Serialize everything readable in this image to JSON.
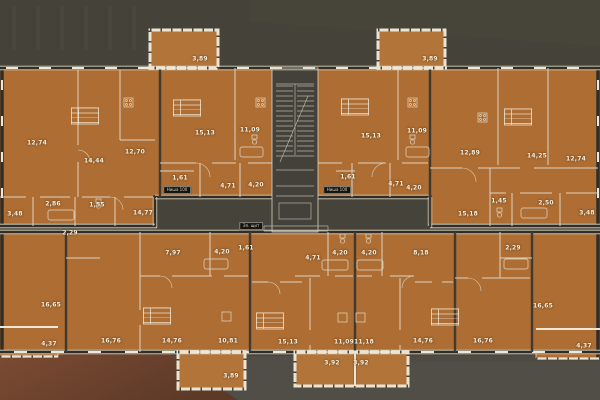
{
  "meta": {
    "title": "Типовой этаж — план квартир",
    "units": "m2"
  },
  "colors": {
    "background_top": "#46433a",
    "background_bottom": "#514e47",
    "plan_fill": "#ad6d33",
    "wall_light": "#ddd4c0",
    "window_light": "#efe8d8",
    "wall_dark": "#312e28",
    "rust_overlay": "#7c4b33",
    "label_text": "#f7eedd"
  },
  "rooms": [
    {
      "label": "12,74",
      "x": 37,
      "y": 143
    },
    {
      "label": "14,44",
      "x": 94,
      "y": 161
    },
    {
      "label": "12,70",
      "x": 135,
      "y": 152
    },
    {
      "label": "3,48",
      "x": 15,
      "y": 214
    },
    {
      "label": "2,86",
      "x": 53,
      "y": 204
    },
    {
      "label": "1,55",
      "x": 97,
      "y": 205
    },
    {
      "label": "14,77",
      "x": 143,
      "y": 213
    },
    {
      "label": "3,89",
      "x": 200,
      "y": 59
    },
    {
      "label": "15,13",
      "x": 205,
      "y": 133
    },
    {
      "label": "11,09",
      "x": 250,
      "y": 130
    },
    {
      "label": "1,61",
      "x": 180,
      "y": 178
    },
    {
      "label": "4,71",
      "x": 228,
      "y": 186
    },
    {
      "label": "4,20",
      "x": 256,
      "y": 185
    },
    {
      "label": "3,89",
      "x": 430,
      "y": 59
    },
    {
      "label": "15,13",
      "x": 371,
      "y": 136
    },
    {
      "label": "11,09",
      "x": 417,
      "y": 131
    },
    {
      "label": "1,61",
      "x": 348,
      "y": 177
    },
    {
      "label": "4,71",
      "x": 396,
      "y": 184
    },
    {
      "label": "4,20",
      "x": 414,
      "y": 188
    },
    {
      "label": "12,89",
      "x": 470,
      "y": 153
    },
    {
      "label": "14,25",
      "x": 537,
      "y": 156
    },
    {
      "label": "12,74",
      "x": 576,
      "y": 159
    },
    {
      "label": "15,18",
      "x": 468,
      "y": 214
    },
    {
      "label": "1,45",
      "x": 499,
      "y": 201
    },
    {
      "label": "2,50",
      "x": 546,
      "y": 203
    },
    {
      "label": "3,48",
      "x": 587,
      "y": 213
    },
    {
      "label": "2,29",
      "x": 70,
      "y": 233
    },
    {
      "label": "16,65",
      "x": 51,
      "y": 305
    },
    {
      "label": "4,37",
      "x": 49,
      "y": 344
    },
    {
      "label": "7,97",
      "x": 173,
      "y": 253
    },
    {
      "label": "4,20",
      "x": 222,
      "y": 252
    },
    {
      "label": "16,76",
      "x": 111,
      "y": 341
    },
    {
      "label": "14,76",
      "x": 172,
      "y": 341
    },
    {
      "label": "10,81",
      "x": 228,
      "y": 341
    },
    {
      "label": "3,89",
      "x": 231,
      "y": 376
    },
    {
      "label": "1,61",
      "x": 246,
      "y": 248
    },
    {
      "label": "4,71",
      "x": 313,
      "y": 258
    },
    {
      "label": "4,20",
      "x": 340,
      "y": 253
    },
    {
      "label": "15,13",
      "x": 288,
      "y": 342
    },
    {
      "label": "11,09",
      "x": 344,
      "y": 342
    },
    {
      "label": "3,92",
      "x": 332,
      "y": 363
    },
    {
      "label": "4,20",
      "x": 369,
      "y": 253
    },
    {
      "label": "11,18",
      "x": 364,
      "y": 342
    },
    {
      "label": "3,92",
      "x": 361,
      "y": 363
    },
    {
      "label": "8,18",
      "x": 421,
      "y": 253
    },
    {
      "label": "14,76",
      "x": 423,
      "y": 341
    },
    {
      "label": "16,76",
      "x": 483,
      "y": 341
    },
    {
      "label": "2,29",
      "x": 513,
      "y": 248
    },
    {
      "label": "16,65",
      "x": 543,
      "y": 306
    },
    {
      "label": "4,37",
      "x": 584,
      "y": 346
    }
  ],
  "tags": [
    {
      "label": "Ниша 100",
      "x": 177,
      "y": 190
    },
    {
      "label": "Ниша 100",
      "x": 337,
      "y": 190
    },
    {
      "label": "Эл. щит",
      "x": 251,
      "y": 226
    }
  ],
  "stamps": [
    {
      "x": 85,
      "y": 116
    },
    {
      "x": 187,
      "y": 108
    },
    {
      "x": 355,
      "y": 107
    },
    {
      "x": 518,
      "y": 117
    },
    {
      "x": 157,
      "y": 316
    },
    {
      "x": 270,
      "y": 321
    },
    {
      "x": 445,
      "y": 317
    }
  ]
}
